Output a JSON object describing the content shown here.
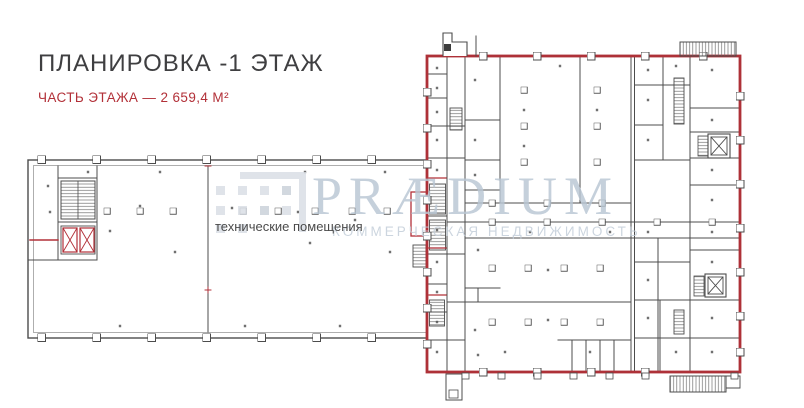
{
  "header": {
    "title": "ПЛАНИРОВКА -1 ЭТАЖ",
    "subtitle": "ЧАСТЬ ЭТАЖА — 2 659,4 М²"
  },
  "plan": {
    "technical_rooms_label": "технические помещения"
  },
  "watermark": {
    "brand": "PRÆDIUM",
    "tagline": "КОММЕРЧЕСКАЯ НЕДВИЖИМОСТЬ"
  },
  "colors": {
    "accent_red": "#b23038",
    "plan_outline_red": "#ae3138",
    "wall_gray": "#4c4c4c",
    "watermark_blue_gray": "#b9c6d4",
    "title_text": "#3f3f41"
  }
}
